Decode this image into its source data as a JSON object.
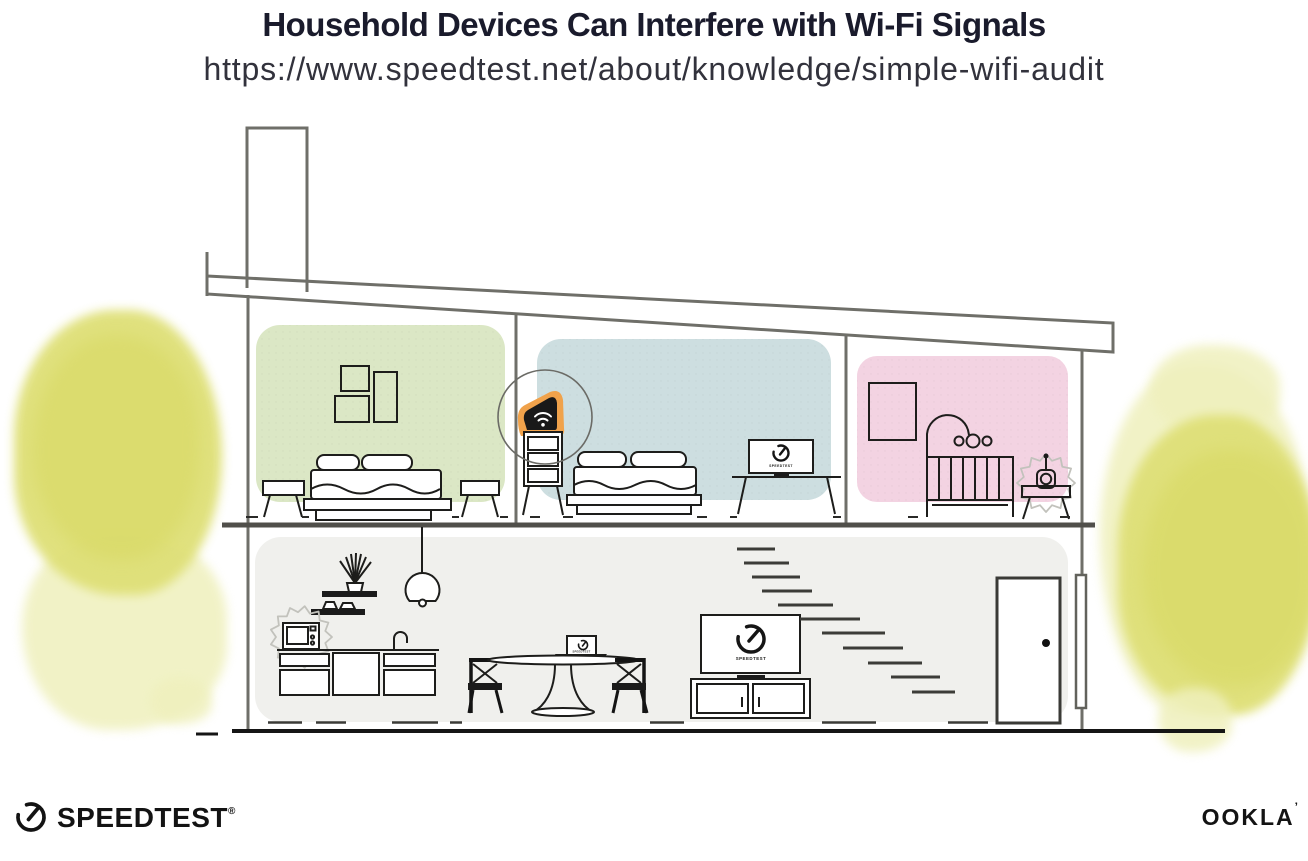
{
  "header": {
    "title": "Household Devices Can Interfere with Wi-Fi Signals",
    "subtitle_url": "https://www.speedtest.net/about/knowledge/simple-wifi-audit"
  },
  "illustration": {
    "screens": {
      "bedroom_monitor_label": "SPEEDTEST",
      "dining_laptop_label": "SPEEDTEST",
      "living_tv_label": "SPEEDTEST"
    },
    "colors": {
      "bedroom_green": "#dbe7c5",
      "bedroom_blue": "#cddee0",
      "nursery_pink": "#f3d3e2",
      "downstairs_grey": "#f0f0ed",
      "router_highlight_orange": "#f0a24b",
      "router_black": "#191919",
      "foliage_yellow_core": "#dfe078",
      "foliage_yellow_wash": "#eff0bd",
      "structure_grey": "#6f6f69",
      "furniture_ink": "#1d1d1b",
      "interference_grey": "#c2c2bc"
    }
  },
  "footer": {
    "speedtest_wordmark": "SPEEDTEST",
    "speedtest_registered": "®",
    "ookla_wordmark": "OOKLA",
    "ookla_trademark": "’"
  }
}
